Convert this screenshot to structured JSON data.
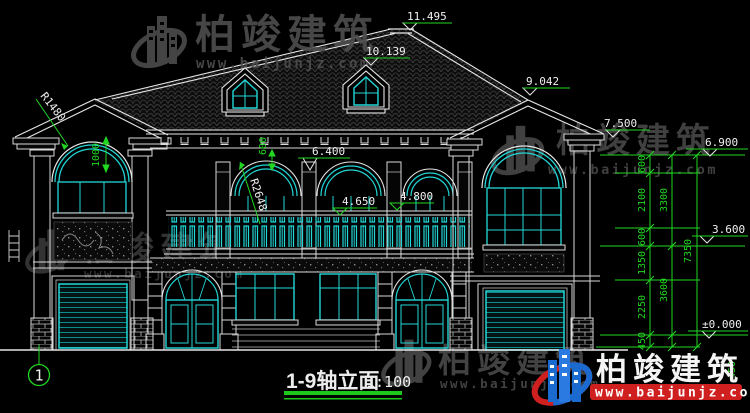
{
  "drawing": {
    "title": "1-9轴立面",
    "scale": "1:100",
    "axis_bubble": "1"
  },
  "watermark": {
    "brand": "柏竣建筑",
    "url": "www.baijunjz.com"
  },
  "elevations": {
    "ridge": "11.495",
    "dormer_top": "10.139",
    "right_gable": "9.042",
    "right_eave": "7.500",
    "eave": "6.900",
    "center_eave": "6.400",
    "balcony_rail": "4.650",
    "door_head": "4.800",
    "second_floor": "3.600",
    "ground": "±0.000"
  },
  "dimensions": {
    "chain_inner": [
      "600",
      "2100",
      "600",
      "1350",
      "2250",
      "450"
    ],
    "chain_mid": [
      "3300",
      "3600",
      "450"
    ],
    "chain_total": "7350",
    "left_arch_rise": "1000",
    "eave_band": "600",
    "radius_left": "R1480",
    "radius_center": "R2648"
  },
  "colors": {
    "background": "#000000",
    "line_white": "#e6e6e6",
    "line_cyan": "#23d7d7",
    "dim_green": "#22d622",
    "watermark_gray": "#4a4a4a",
    "logo_blue": "#1b6ad0",
    "logo_red": "#cf1f1f"
  }
}
